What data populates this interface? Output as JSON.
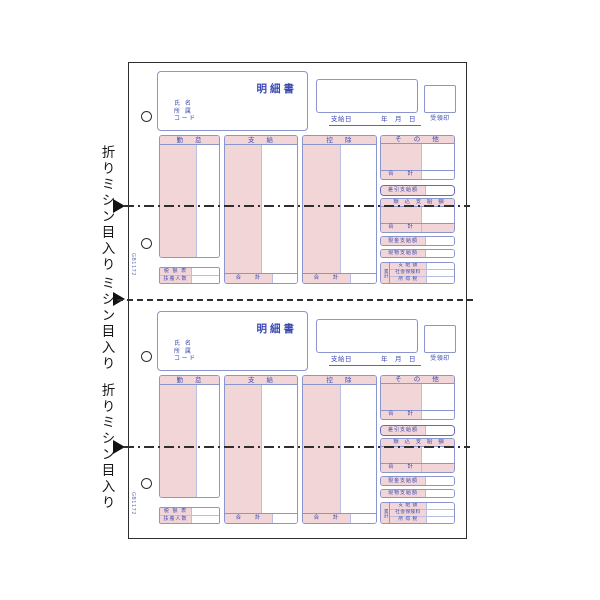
{
  "page": {
    "margin_labels": [
      {
        "text": "折りミシン目入り"
      },
      {
        "text": "ミシン目入り"
      },
      {
        "text": "折りミシン目入り"
      }
    ],
    "product_code": "GB1172",
    "colors": {
      "form_line": "#8b95ce",
      "form_text": "#3a4ab2",
      "pink_fill": "#f2d5d7",
      "annotation": "#161616"
    }
  },
  "form": {
    "title": "明細書",
    "recipient": {
      "name_label": "氏 名",
      "dept_label": "所 属",
      "code_label": "コード"
    },
    "date": {
      "pay_date_label": "支給日",
      "year_label": "年",
      "month_label": "月",
      "day_label": "日",
      "receipt_label": "受領印"
    },
    "columns": {
      "attendance": "勤 怠",
      "payment": "支 給",
      "deduction": "控 除",
      "other": "そ の 他"
    },
    "total_label": "合 計",
    "net_pay_label": "差引支給額",
    "transfer_label": "振 込 支 給 額",
    "cash_label": "現金支給額",
    "in_kind_label": "現物支給額",
    "cumulative": {
      "label": "累計",
      "pay_label": "支 給 額",
      "insurance_label": "社会保険料",
      "tax_label": "所 得 税"
    },
    "tax_table_label": "税 額 表",
    "dependents_label": "扶養人数"
  }
}
